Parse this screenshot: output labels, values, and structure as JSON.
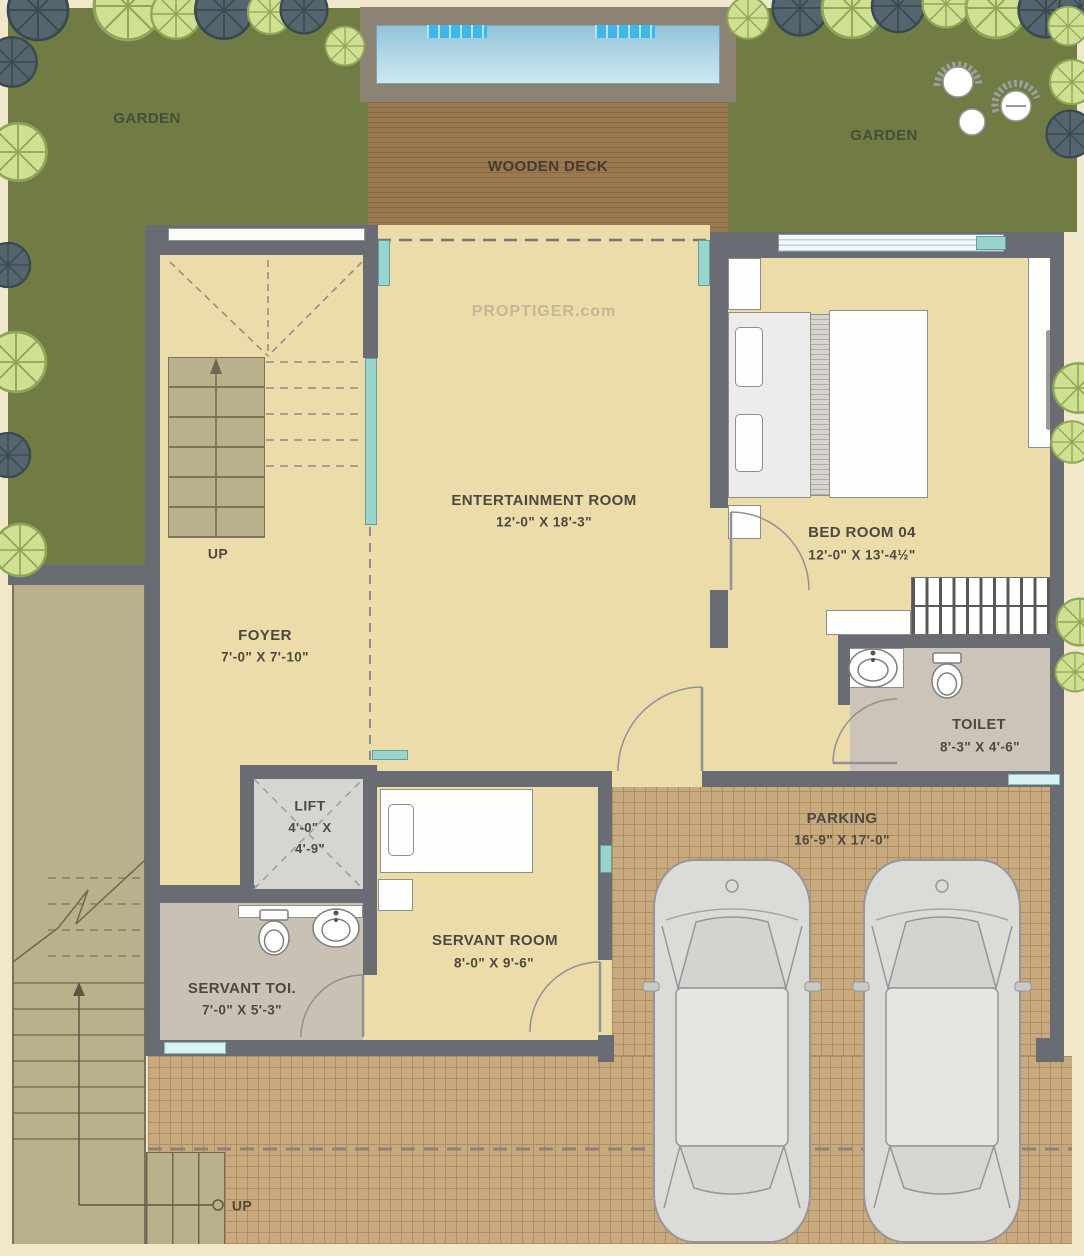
{
  "watermark": "PROPTIGER.com",
  "palette": {
    "garden_green": "#707c43",
    "wall_gray": "#696d73",
    "floor_cream": "#ecdcaa",
    "deck_brown": "#9a7951",
    "pool_blue": "#93c4da",
    "pool_step_blue": "#3fb6e8",
    "brick_tan": "#c9aa7e",
    "stair_olive": "#b9b08c",
    "bath_gray": "#ccc4b8",
    "window_teal": "#9ad4cf",
    "label_text": "#4b4a40"
  },
  "areas": {
    "garden_left": {
      "label": "GARDEN"
    },
    "garden_right": {
      "label": "GARDEN"
    },
    "deck": {
      "label": "WOODEN DECK"
    },
    "entertainment": {
      "label": "ENTERTAINMENT ROOM",
      "dims": "12'-0\" X 18'-3\""
    },
    "bedroom": {
      "label": "BED ROOM 04",
      "dims": "12'-0\" X 13'-4½\""
    },
    "foyer": {
      "label": "FOYER",
      "dims": "7'-0\" X 7'-10\""
    },
    "stairs_up": {
      "label": "UP"
    },
    "lift": {
      "label": "LIFT",
      "dims1": "4'-0\" X",
      "dims2": "4'-9\""
    },
    "toilet": {
      "label": "TOILET",
      "dims": "8'-3\" X 4'-6\""
    },
    "servant_toilet": {
      "label": "SERVANT TOI.",
      "dims": "7'-0\" X 5'-3\""
    },
    "servant_room": {
      "label": "SERVANT ROOM",
      "dims": "8'-0\" X 9'-6\""
    },
    "parking": {
      "label": "PARKING",
      "dims": "16'-9\" X 17'-0\""
    },
    "outer_stairs_up": {
      "label": "UP"
    }
  }
}
